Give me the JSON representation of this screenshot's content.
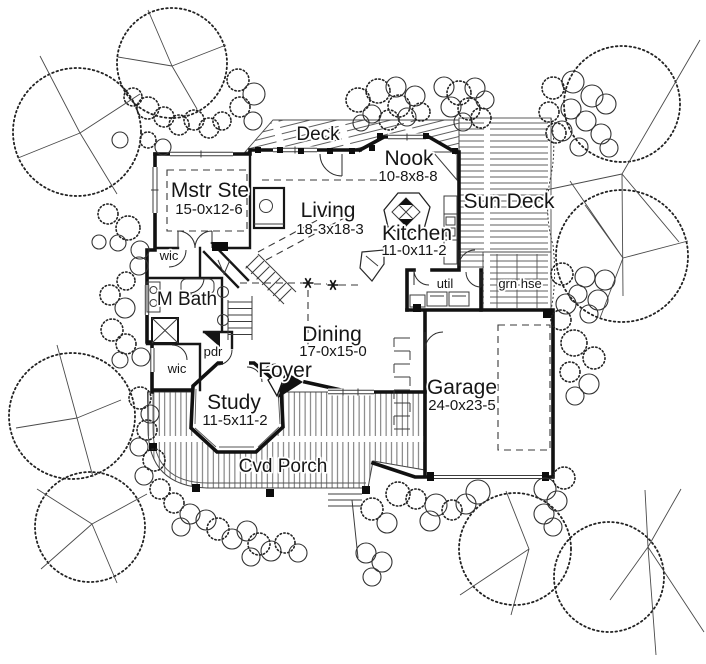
{
  "palette": {
    "paper": "#ffffff",
    "ink": "#161616",
    "hatch": "#5f5f5f"
  },
  "rooms": {
    "deck": {
      "label": "Deck"
    },
    "nook": {
      "label": "Nook",
      "dims": "10-8x8-8"
    },
    "mstr_ste": {
      "label": "Mstr Ste",
      "dims": "15-0x12-6"
    },
    "living": {
      "label": "Living",
      "dims": "18-3x18-3"
    },
    "kitchen": {
      "label": "Kitchen",
      "dims": "11-0x11-2"
    },
    "sun_deck": {
      "label": "Sun Deck"
    },
    "wic_upper": {
      "label": "wic"
    },
    "m_bath": {
      "label": "M Bath"
    },
    "util": {
      "label": "util"
    },
    "grn_hse": {
      "label": "grn hse"
    },
    "dining": {
      "label": "Dining",
      "dims": "17-0x15-0"
    },
    "pdr": {
      "label": "pdr"
    },
    "wic_lower": {
      "label": "wic"
    },
    "foyer": {
      "label": "Foyer"
    },
    "study": {
      "label": "Study",
      "dims": "11-5x11-2"
    },
    "garage": {
      "label": "Garage",
      "dims": "24-0x23-5"
    },
    "cvd_porch": {
      "label": "Cvd Porch"
    }
  }
}
